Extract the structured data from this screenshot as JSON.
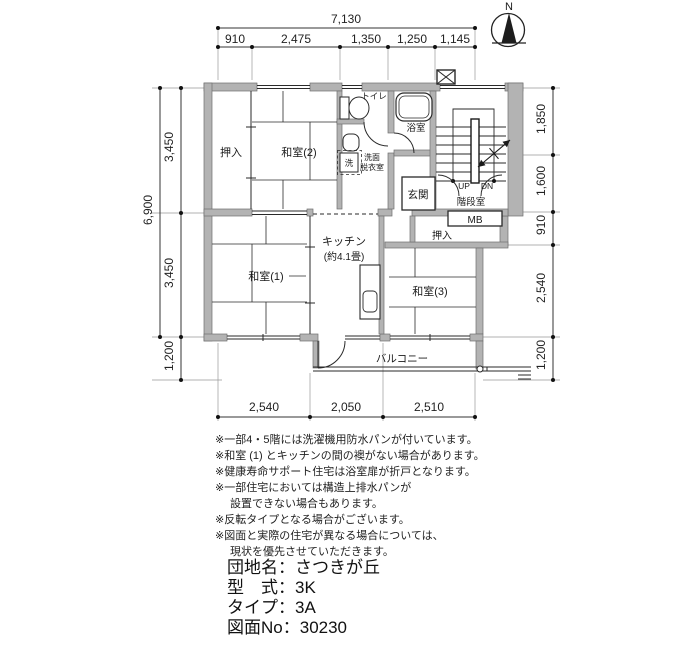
{
  "compass": {
    "label": "N"
  },
  "colors": {
    "wall": "#b3b3b3",
    "line": "#2a2a2a",
    "dim_line": "#444444"
  },
  "dimensions": {
    "top": {
      "total": "7,130",
      "segments": [
        "910",
        "2,475",
        "1,350",
        "1,250",
        "1,145"
      ]
    },
    "left": {
      "total": "6,900",
      "upper": "3,450",
      "lower": "3,450",
      "balcony": "1,200"
    },
    "right": {
      "segments": [
        "1,850",
        "1,600",
        "910",
        "2,540",
        "1,200"
      ]
    },
    "bottom": {
      "segments": [
        "2,540",
        "2,050",
        "2,510"
      ]
    }
  },
  "rooms": {
    "oshiire_2": "押入",
    "washitsu_2": "和室(2)",
    "toilet": "トイレ",
    "bath": "浴室",
    "washroom_l1": "洗面",
    "washroom_l2": "脱衣室",
    "washer": "洗",
    "genkan": "玄関",
    "stairwell": "階段室",
    "up": "UP",
    "dn": "DN",
    "mb": "MB",
    "oshiire_3": "押入",
    "kitchen_l1": "キッチン",
    "kitchen_l2": "(約4.1畳)",
    "washitsu_1": "和室(1)",
    "washitsu_3": "和室(3)",
    "balcony": "バルコニー"
  },
  "notes": [
    "※一部4・5階には洗濯機用防水パンが付いています。",
    "※和室 (1) とキッチンの間の襖がない場合があります。",
    "※健康寿命サポート住宅は浴室扉が折戸となります。",
    "※一部住宅においては構造上排水パンが",
    "設置できない場合もあります。",
    "※反転タイプとなる場合がございます。",
    "※図面と実際の住宅が異なる場合については、",
    "現状を優先させていただきます。"
  ],
  "footer": {
    "separator": "：",
    "rows": [
      {
        "label": "団地名",
        "value": "さつきが丘"
      },
      {
        "label": "型　式",
        "value": "3K"
      },
      {
        "label": "タイプ",
        "value": "3A"
      },
      {
        "label": "図面No",
        "value": "30230"
      }
    ]
  }
}
